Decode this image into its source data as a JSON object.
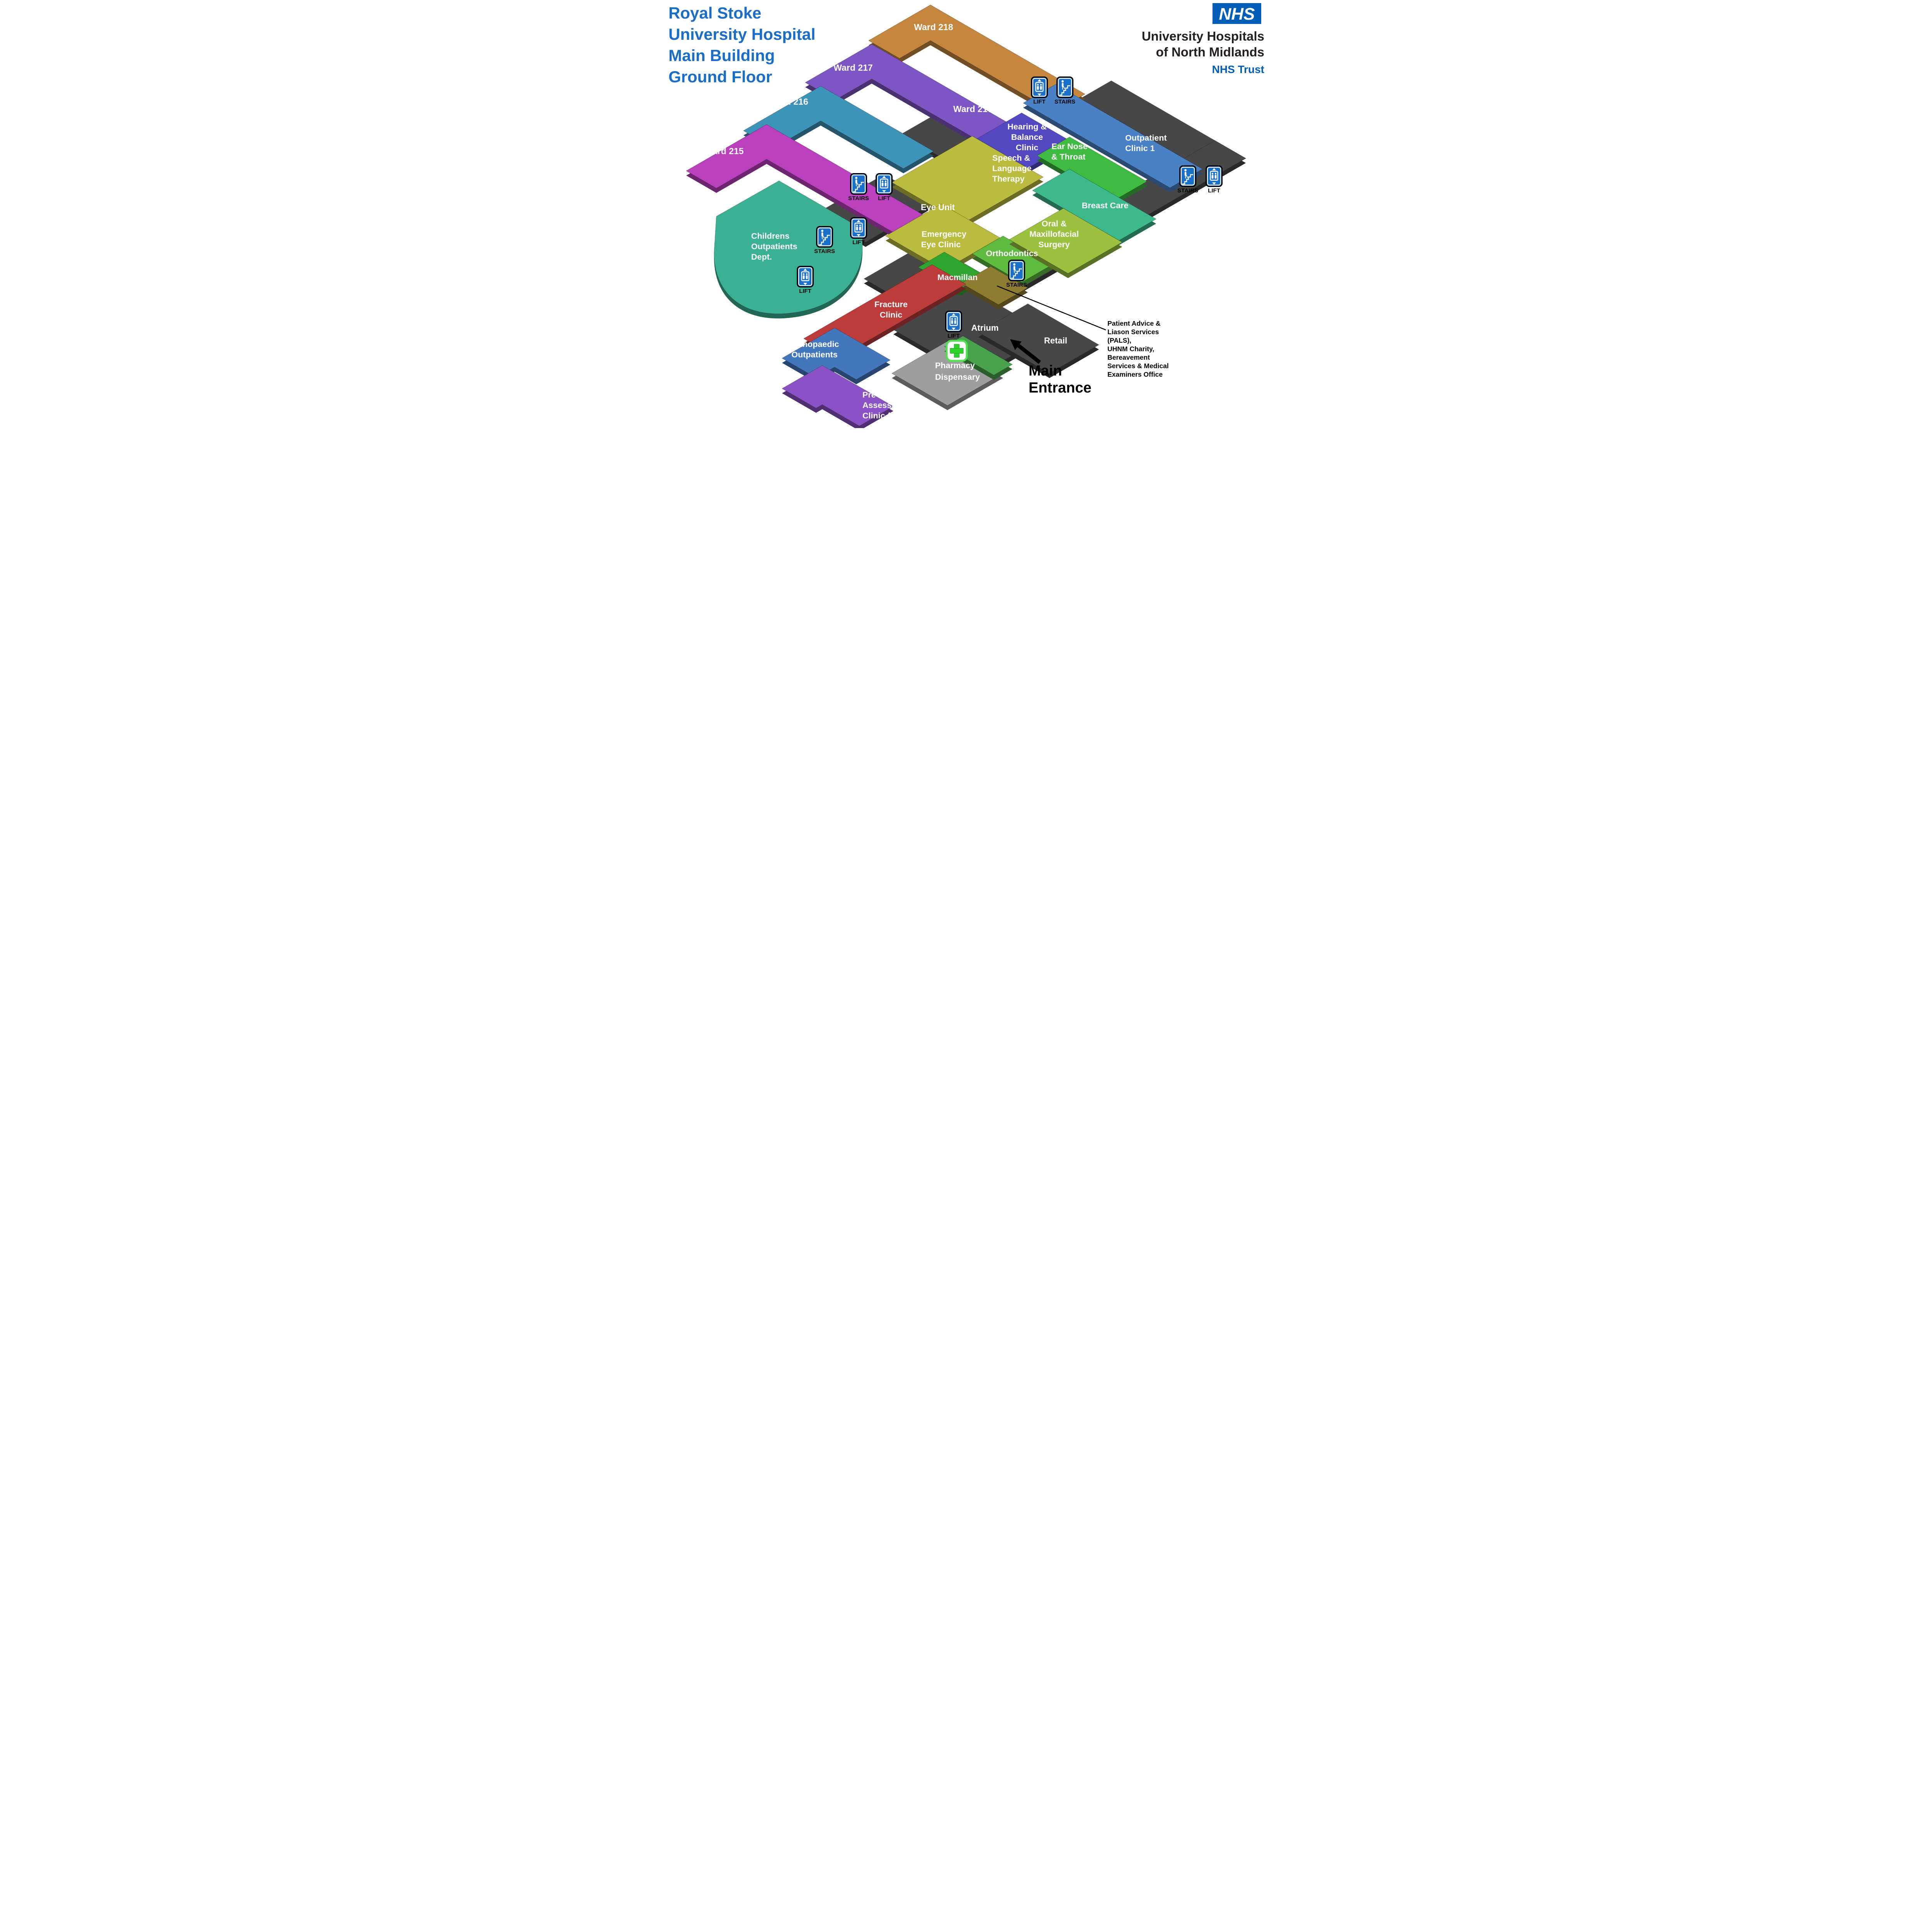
{
  "title": {
    "lines": [
      "Royal Stoke",
      "University Hospital",
      "Main Building",
      "Ground Floor"
    ],
    "color": "#1B6EC8"
  },
  "nhs": {
    "logo": "NHS",
    "org": [
      "University Hospitals",
      "of North Midlands"
    ],
    "trust": "NHS Trust",
    "blue": "#005EB8"
  },
  "map": {
    "areas": {
      "ward-218": {
        "label": [
          "Ward 218"
        ],
        "color": "#C5873E"
      },
      "ward-217": {
        "label": [
          "Ward 217"
        ],
        "color": "#7E55C4"
      },
      "ward-217a": {
        "label": [
          "Ward 217A"
        ]
      },
      "ward-216": {
        "label": [
          "Ward 216"
        ],
        "color": "#3E93B8"
      },
      "ward-215": {
        "label": [
          "Ward 215"
        ],
        "color": "#BB40BE"
      },
      "childrens-outpatients": {
        "label": [
          "Childrens",
          "Outpatients",
          "Dept."
        ],
        "color": "#3BB193"
      },
      "outpatient-clinic-1": {
        "label": [
          "Outpatient",
          "Clinic 1"
        ],
        "color": "#4A80C4"
      },
      "hearing-balance-clinic": {
        "label": [
          "Hearing &",
          "Balance",
          "Clinic"
        ],
        "color": "#5348C2"
      },
      "ear-nose-throat": {
        "label": [
          "Ear Nose",
          "& Throat"
        ],
        "color": "#3EBB40"
      },
      "speech-language-therapy": {
        "label": [
          "Speech &",
          "Language",
          "Therapy"
        ]
      },
      "eye-unit": {
        "label": [
          "Eye Unit"
        ],
        "color": "#BBBB40"
      },
      "emergency-eye-clinic": {
        "label": [
          "Emergency",
          "Eye Clinic"
        ],
        "color": "#BBBB40"
      },
      "breast-care": {
        "label": [
          "Breast Care"
        ],
        "color": "#3CBA8C"
      },
      "oral-maxillofacial-surgery": {
        "label": [
          "Oral &",
          "Maxillofacial",
          "Surgery"
        ],
        "color": "#9CC13F"
      },
      "orthodontics": {
        "label": [
          "Orthodontics"
        ],
        "color": "#5FBB40"
      },
      "macmillan": {
        "label": [
          "Macmillan"
        ],
        "color": "#2FA42F"
      },
      "pals-offices": {
        "color": "#8E7C31"
      },
      "fracture-clinic": {
        "label": [
          "Fracture",
          "Clinic"
        ],
        "color": "#BC3C3C"
      },
      "orthopaedic-outpatients": {
        "label": [
          "Orthopaedic",
          "Outpatients"
        ],
        "color": "#4377BD"
      },
      "pre-assessment-clinic": {
        "label": [
          "Pre",
          "Assessment",
          "Clinic (PreAMS)"
        ],
        "color": "#8A52C6"
      },
      "pharmacy-dispensary": {
        "label": [
          "Pharmacy",
          "Dispensary"
        ],
        "color": "#9E9E9E"
      },
      "entrance-green": {
        "color": "#48A34C"
      },
      "corridor": {
        "color": "#474747"
      },
      "atrium": {
        "label": [
          "Atrium"
        ],
        "color": "#474747"
      },
      "retail": {
        "label": [
          "Retail"
        ],
        "color": "#474747"
      }
    },
    "icons": [
      {
        "kind": "lift",
        "label": "LIFT"
      },
      {
        "kind": "stairs",
        "label": "STAIRS"
      },
      {
        "kind": "stairs",
        "label": "STAIRS"
      },
      {
        "kind": "lift",
        "label": "LIFT"
      },
      {
        "kind": "stairs",
        "label": "STAIRS"
      },
      {
        "kind": "lift",
        "label": "LIFT"
      },
      {
        "kind": "lift",
        "label": "LIFT"
      },
      {
        "kind": "stairs",
        "label": "STAIRS"
      },
      {
        "kind": "lift",
        "label": "LIFT"
      },
      {
        "kind": "stairs",
        "label": "STAIRS"
      },
      {
        "kind": "lift",
        "label": "LIFT"
      }
    ],
    "notes": {
      "pals_note": [
        "Patient Advice &",
        "Liason Services",
        "(PALS),",
        "UHNM Charity,",
        "Bereavement",
        "Services & Medical",
        "Examiners Office"
      ],
      "main_entrance": [
        "Main",
        "Entrance"
      ]
    },
    "icon_colors": {
      "sign_blue": "#1A6FC9",
      "cross_green": "#2BD42B"
    }
  }
}
